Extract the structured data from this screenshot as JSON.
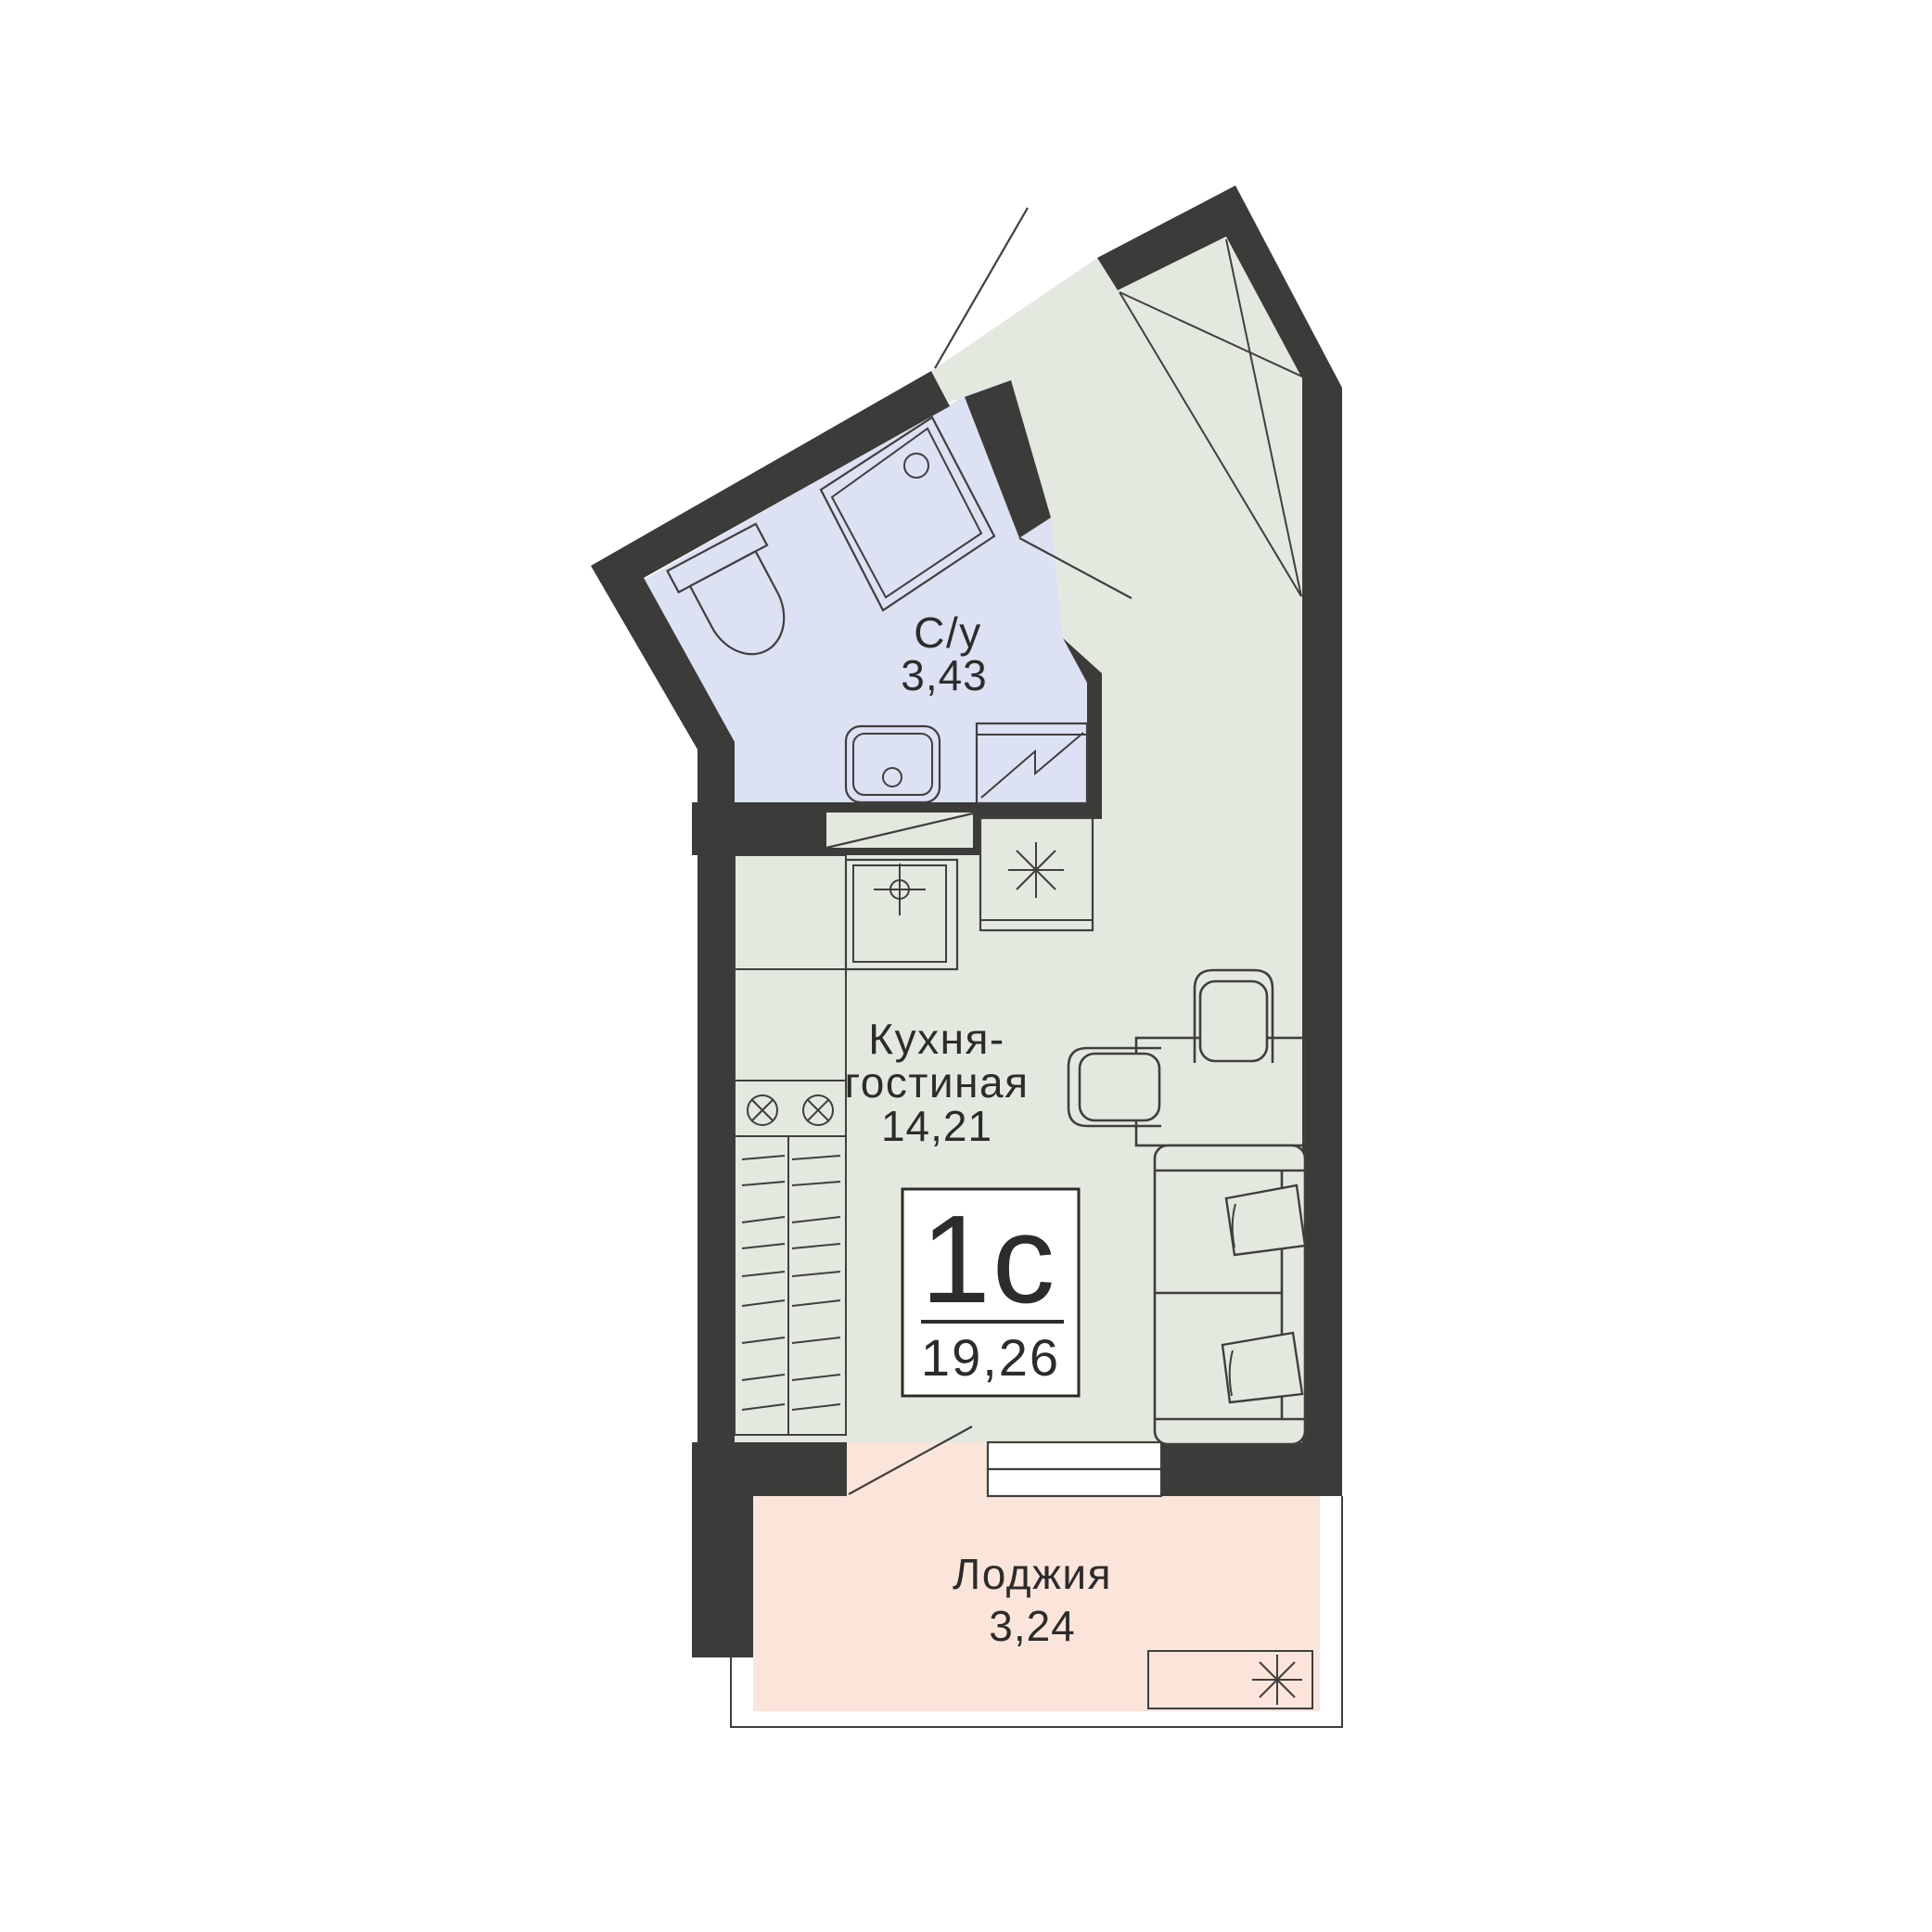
{
  "plan": {
    "badge": {
      "type": "1с",
      "area": "19,26"
    },
    "rooms": {
      "bathroom": {
        "name": "С/у",
        "area": "3,43"
      },
      "kitchen_living": {
        "name_line1": "Кухня-",
        "name_line2": "гостиная",
        "area": "14,21"
      },
      "loggia": {
        "name": "Лоджия",
        "area": "3,24"
      }
    },
    "icons": [
      "toilet-icon",
      "shower-tray-icon",
      "washbasin-icon",
      "washing-machine-icon",
      "kitchen-sink-icon",
      "stove-burner-icon",
      "fridge-snowflake-icon",
      "wardrobe-icon",
      "table-icon",
      "chair-icon",
      "sofa-icon",
      "pillow-icon",
      "ac-unit-snowflake-icon",
      "door-swing-icon",
      "window-casement-icon"
    ]
  },
  "colors": {
    "wall": "#3b3b39",
    "floor_main": "#e4e9e0",
    "floor_bathroom": "#dce1f3",
    "floor_loggia": "#fbe5da",
    "line": "#3f3f3d",
    "text": "#2c2c2b",
    "background": "#ffffff"
  }
}
